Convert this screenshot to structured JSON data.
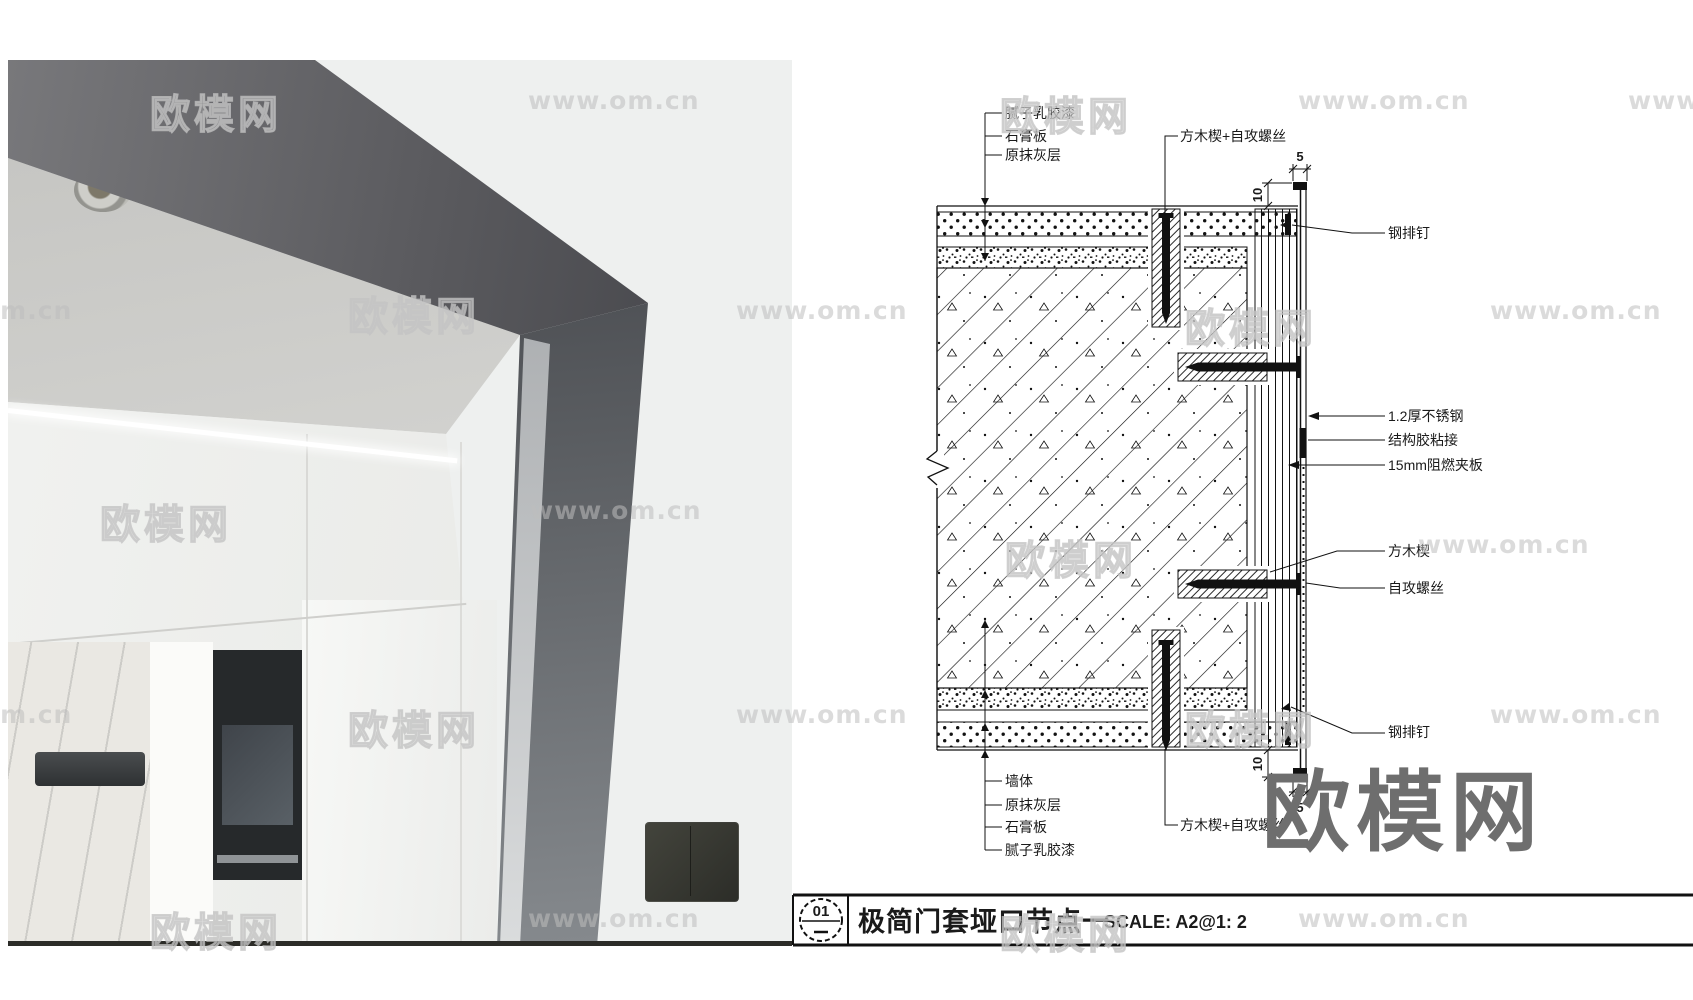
{
  "drawing": {
    "labels": {
      "top_left": [
        "腻子乳胶漆",
        "石膏板",
        "原抹灰层"
      ],
      "top_center": "方木楔+自攻螺丝",
      "bottom_left": [
        "墙体",
        "原抹灰层",
        "石膏板",
        "腻子乳胶漆"
      ],
      "bottom_center": "方木楔+自攻螺丝",
      "right": [
        "钢排钉",
        "1.2厚不锈钢",
        "结构胶粘接",
        "15mm阻燃夹板",
        "方木楔",
        "自攻螺丝",
        "钢排钉"
      ]
    },
    "dimensions": {
      "top_offset": "10",
      "top_return": "5",
      "bottom_offset": "10",
      "bottom_return": "5"
    },
    "title_block": {
      "number": "01",
      "title": "极简门套垭口节点一",
      "scale": "SCALE: A2@1: 2"
    }
  },
  "colors": {
    "frame_metal": "#55565a",
    "wall_beige": "#a19987",
    "line_ink": "#1a1a1a",
    "watermark_gray": "#c3c3c3",
    "big_watermark_gray": "#6e6e6e"
  },
  "watermarks": {
    "items": [
      {
        "text": "欧模网",
        "style": "cn-outline",
        "x": 150,
        "y": 82
      },
      {
        "text": "www.om.cn",
        "style": "site",
        "x": 528,
        "y": 86
      },
      {
        "text": "欧模网",
        "style": "cn-outline",
        "x": 1000,
        "y": 84
      },
      {
        "text": "www.om.cn",
        "style": "site",
        "x": 1298,
        "y": 86
      },
      {
        "text": "www.",
        "style": "site",
        "x": 1628,
        "y": 86
      },
      {
        "text": "om.cn",
        "style": "site",
        "x": -18,
        "y": 296
      },
      {
        "text": "欧模网",
        "style": "cn-outline",
        "x": 348,
        "y": 284
      },
      {
        "text": "www.om.cn",
        "style": "site",
        "x": 736,
        "y": 296
      },
      {
        "text": "欧模网",
        "style": "cn-outline",
        "x": 1185,
        "y": 296
      },
      {
        "text": "www.om.cn",
        "style": "site",
        "x": 1490,
        "y": 296
      },
      {
        "text": "欧模网",
        "style": "cn-outline",
        "x": 100,
        "y": 492
      },
      {
        "text": "www.om.cn",
        "style": "site",
        "x": 530,
        "y": 496
      },
      {
        "text": "欧模网",
        "style": "cn-outline",
        "x": 1005,
        "y": 528
      },
      {
        "text": "www.om.cn",
        "style": "site",
        "x": 1418,
        "y": 530
      },
      {
        "text": "om.cn",
        "style": "site",
        "x": -18,
        "y": 700
      },
      {
        "text": "欧模网",
        "style": "cn-outline",
        "x": 348,
        "y": 698
      },
      {
        "text": "www.om.cn",
        "style": "site",
        "x": 736,
        "y": 700
      },
      {
        "text": "欧模网",
        "style": "cn-outline",
        "x": 1185,
        "y": 698
      },
      {
        "text": "www.om.cn",
        "style": "site",
        "x": 1490,
        "y": 700
      },
      {
        "text": "欧模网",
        "style": "cn-outline",
        "x": 150,
        "y": 900
      },
      {
        "text": "www.om.cn",
        "style": "site",
        "x": 528,
        "y": 904
      },
      {
        "text": "欧模网",
        "style": "cn-outline",
        "x": 1000,
        "y": 902
      },
      {
        "text": "www.om.cn",
        "style": "site",
        "x": 1298,
        "y": 904
      },
      {
        "text": "欧模网",
        "style": "big",
        "x": 1262,
        "y": 742
      }
    ]
  }
}
